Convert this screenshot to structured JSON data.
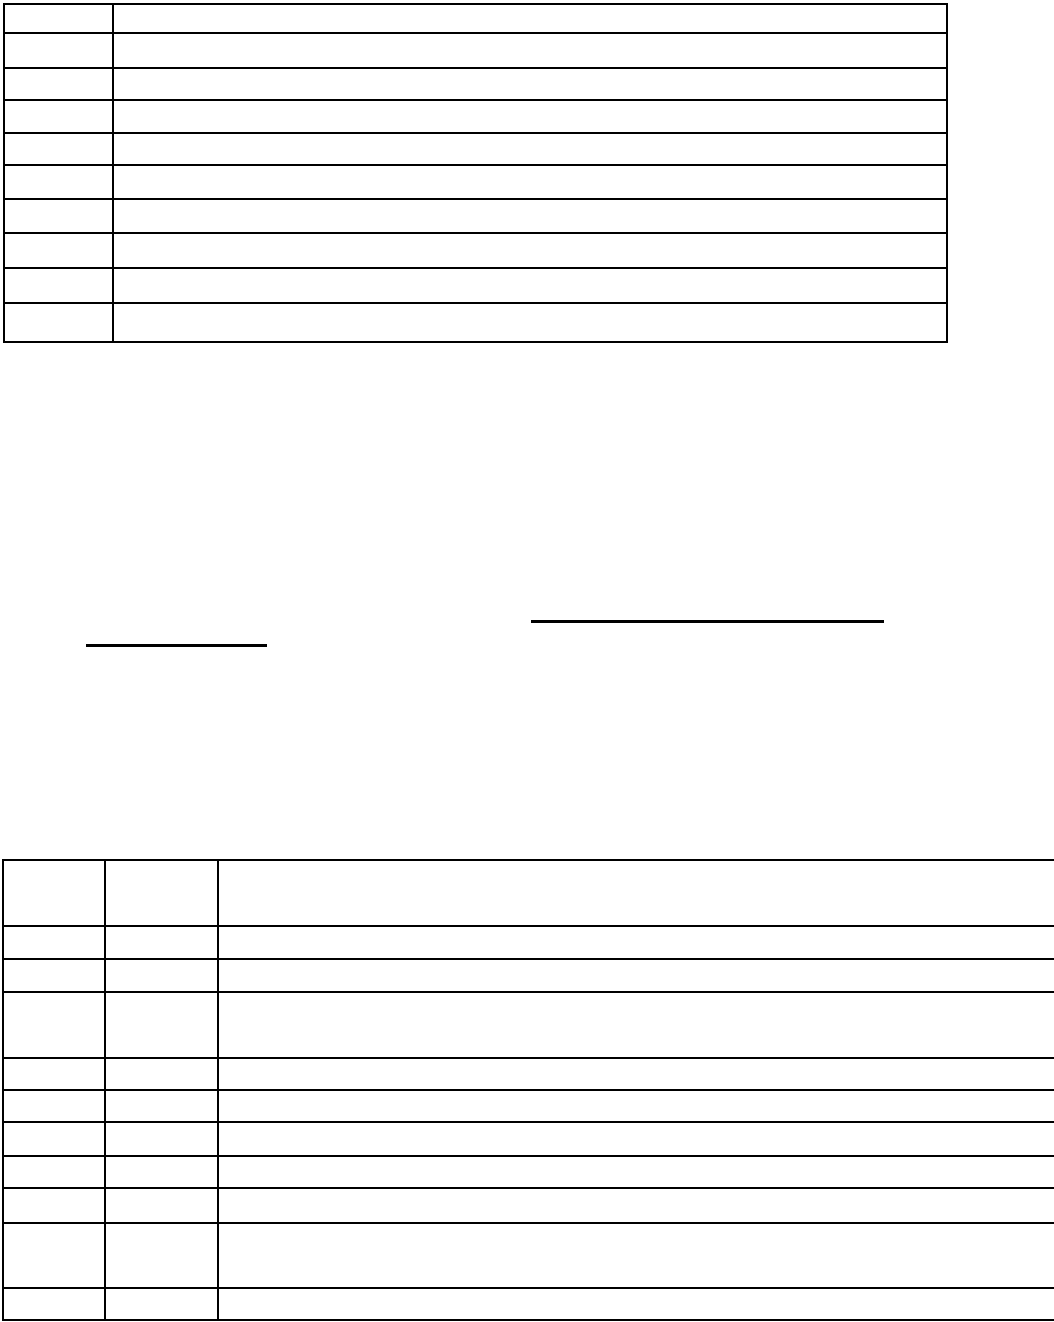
{
  "page": {
    "width_px": 1054,
    "height_px": 1322,
    "background_color": "#ffffff",
    "ink_color": "#000000",
    "visible_text": ""
  },
  "top_table": {
    "x": 3,
    "y": 3,
    "width": 945,
    "columns": 2,
    "column_widths": [
      109,
      834
    ],
    "row_heights": [
      29,
      35,
      32,
      33,
      32,
      34,
      34,
      35,
      35,
      39
    ],
    "cell_text": ""
  },
  "rule_lines": [
    {
      "name": "blank-underline-long",
      "x": 531,
      "y": 620,
      "width": 353,
      "height": 3
    },
    {
      "name": "blank-underline-short",
      "x": 86,
      "y": 644,
      "width": 181,
      "height": 3
    }
  ],
  "bottom_table": {
    "x": 2,
    "y": 859,
    "width": 1200,
    "columns": 3,
    "column_widths": [
      102,
      113,
      985
    ],
    "row_heights": [
      66,
      33,
      33,
      66,
      32,
      32,
      34,
      32,
      35,
      65,
      32
    ],
    "cell_text": ""
  }
}
